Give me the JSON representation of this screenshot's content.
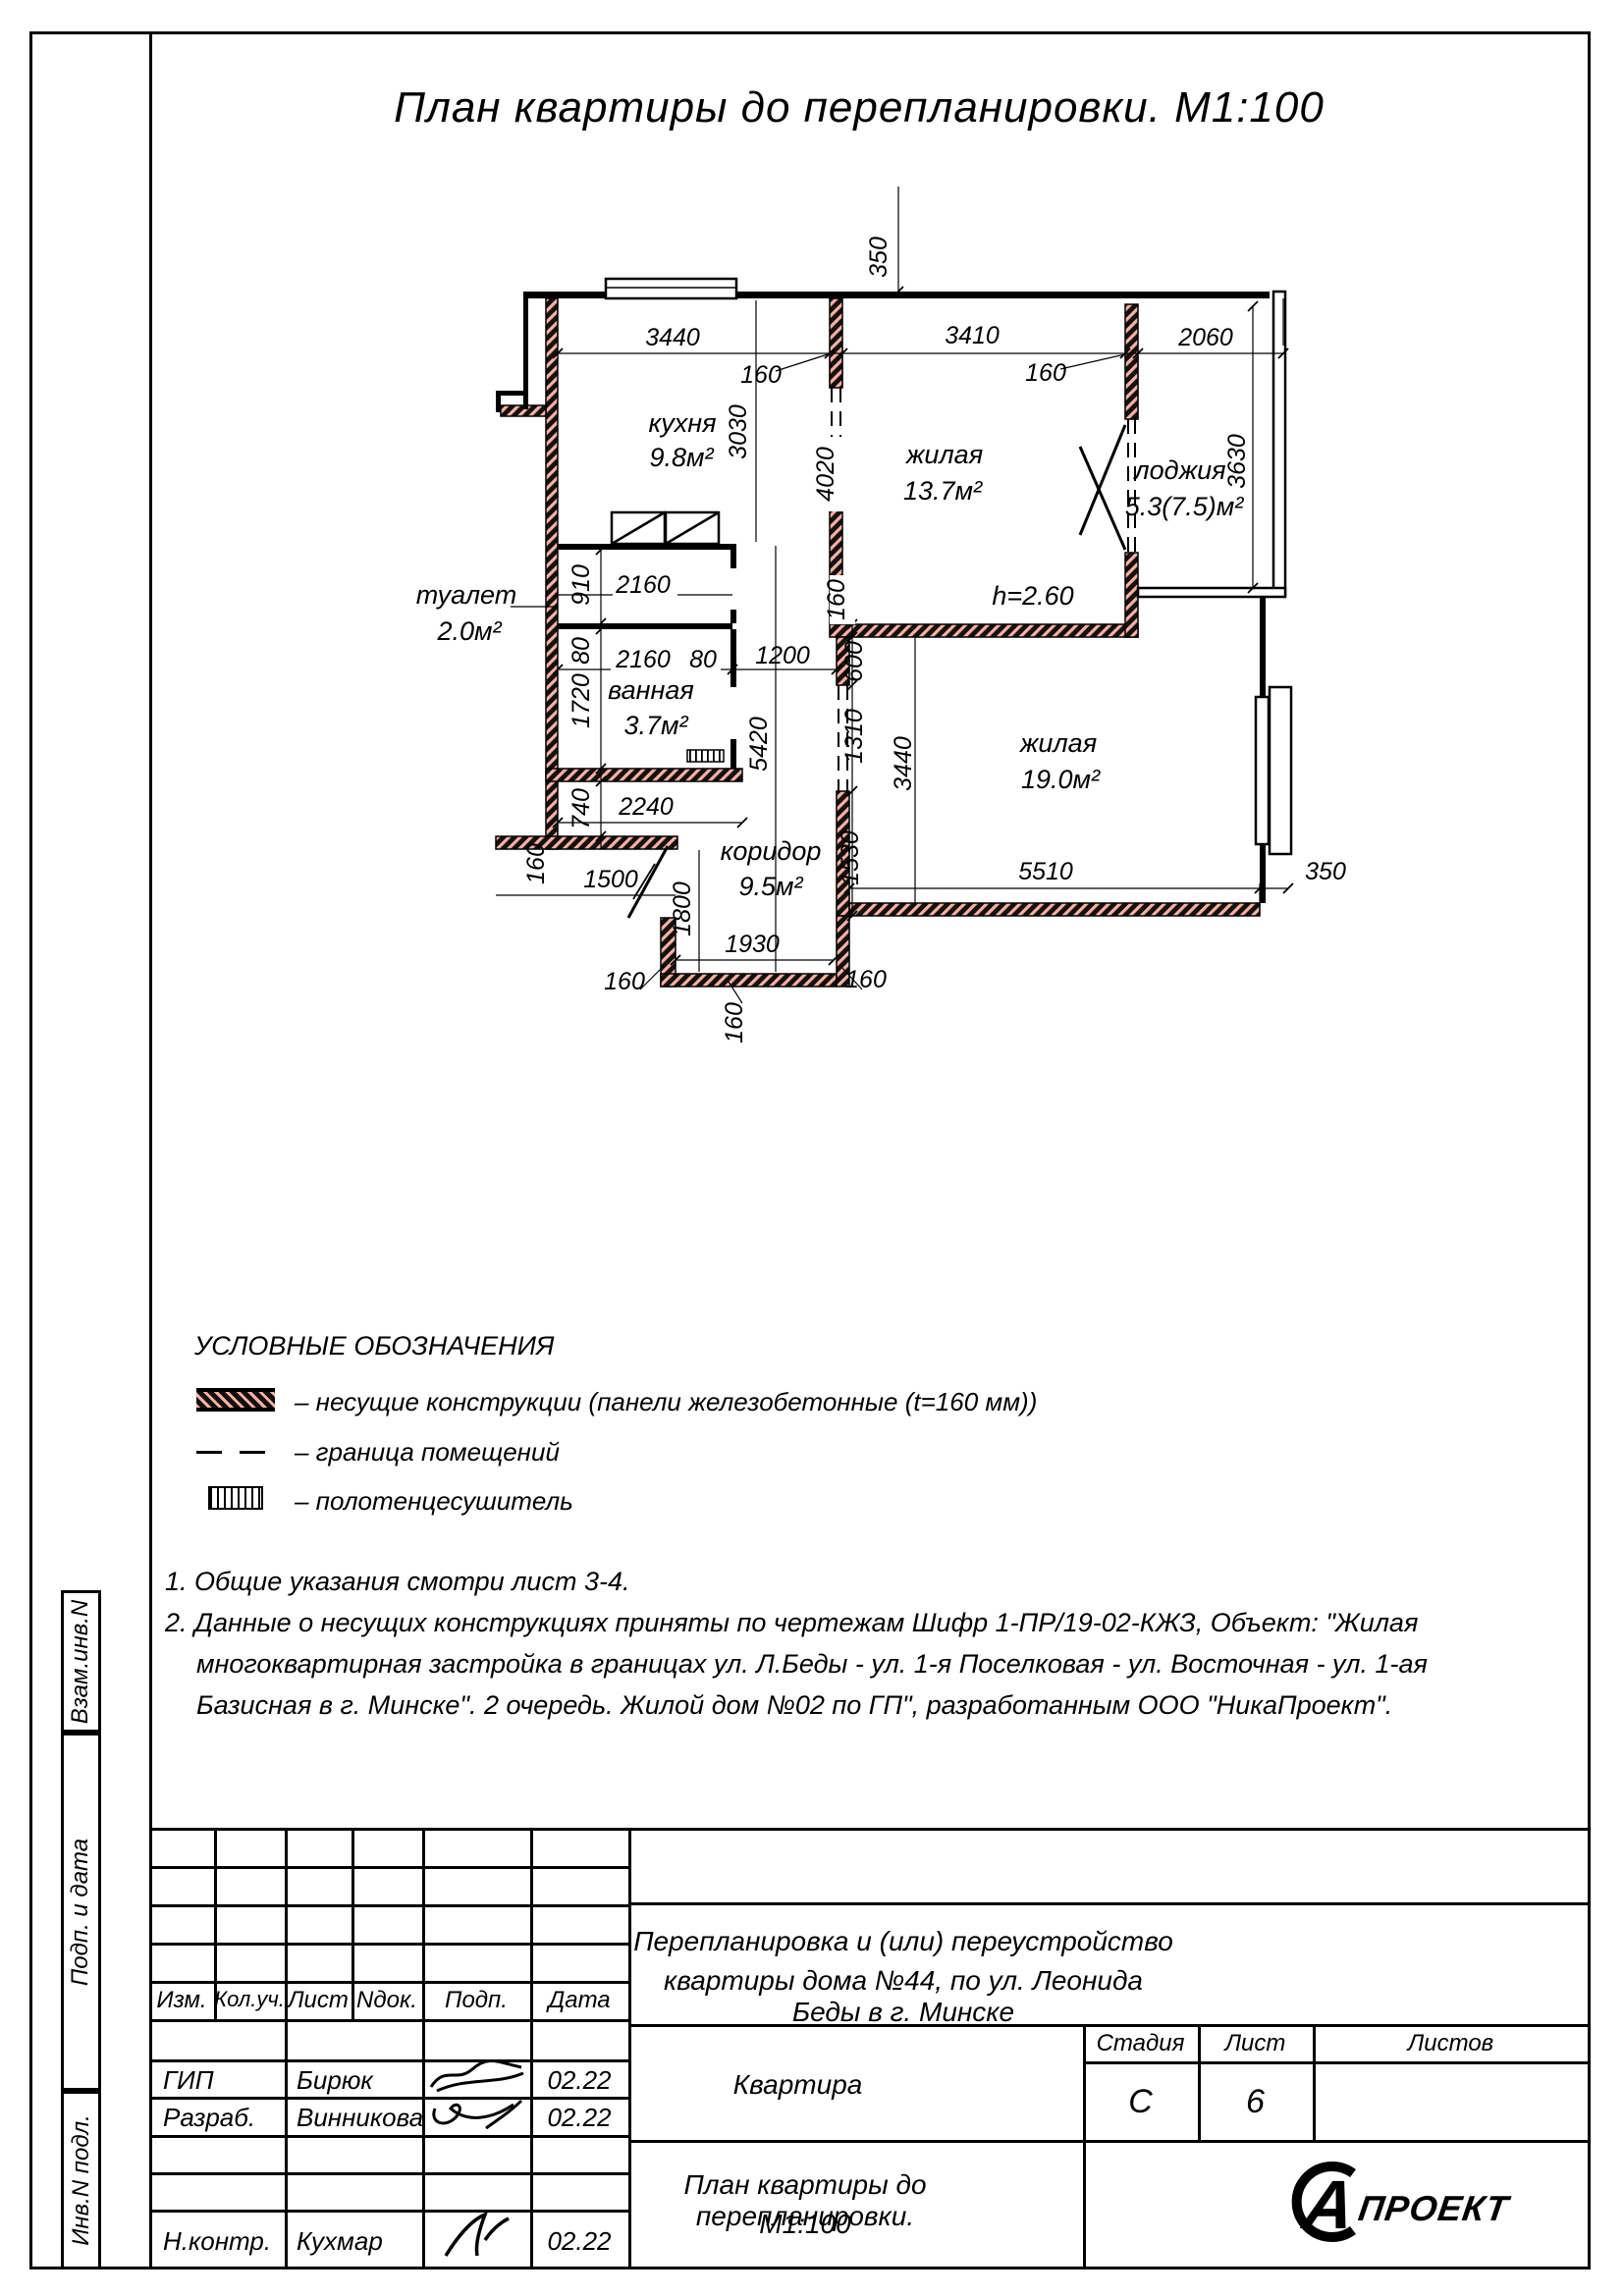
{
  "page_title": "План квартиры до перепланировки. М1:100",
  "plan": {
    "rooms": {
      "kitchen": {
        "name": "кухня",
        "area": "9.8м²"
      },
      "living1": {
        "name": "жилая",
        "area": "13.7м²"
      },
      "loggia": {
        "name": "лоджия",
        "area": "5.3(7.5)м²"
      },
      "toilet": {
        "name": "туалет",
        "area": "2.0м²"
      },
      "bath": {
        "name": "ванная",
        "area": "3.7м²"
      },
      "hall": {
        "name": "коридор",
        "area": "9.5м²"
      },
      "living2": {
        "name": "жилая",
        "area": "19.0м²"
      }
    },
    "height_note": "h=2.60",
    "dims": {
      "d350": "350",
      "d3440": "3440",
      "d160": "160",
      "d3410": "3410",
      "d2060": "2060",
      "d3030": "3030",
      "d4020": "4020",
      "d3630": "3630",
      "d910": "910",
      "d80": "80",
      "d1720": "1720",
      "d740": "740",
      "d2160": "2160",
      "d1200": "1200",
      "d2240": "2240",
      "d5420": "5420",
      "d600": "600",
      "d1310": "1310",
      "d1530": "1530",
      "d5510": "5510",
      "d1930": "1930",
      "d1800": "1800",
      "d1500": "1500"
    },
    "colors": {
      "wall_hatch": "#ffb19c",
      "ink": "#000000"
    }
  },
  "legend": {
    "title": "УСЛОВНЫЕ ОБОЗНАЧЕНИЯ",
    "item1": "– несущие конструкции (панели железобетонные  (t=160 мм))",
    "item2": "– граница помещений",
    "item3": "– полотенцесушитель"
  },
  "notes": {
    "line1": "1. Общие указания смотри лист 3-4.",
    "line2": "2. Данные о несущих конструкциях приняты по чертежам Шифр 1-ПР/19-02-КЖЗ, Объект: \"Жилая",
    "line3": "многоквартирная застройка в границах ул. Л.Беды - ул. 1-я Поселковая - ул. Восточная - ул. 1-ая",
    "line4": "Базисная в г. Минске\". 2 очередь. Жилой дом №02 по ГП\", разработанным ООО \"НикаПроект\"."
  },
  "titleblock": {
    "cols": {
      "c1": "Изм.",
      "c2": "Кол.уч.",
      "c3": "Лист",
      "c4": "Nдок.",
      "c5": "Подп.",
      "c6": "Дата"
    },
    "rows": {
      "r1": {
        "role": "ГИП",
        "name": "Бирюк",
        "date": "02.22"
      },
      "r2": {
        "role": "Разраб.",
        "name": "Винникова",
        "date": "02.22"
      },
      "r3": {
        "role": "Н.контр.",
        "name": "Кухмар",
        "date": "02.22"
      }
    },
    "project_line1": "Перепланировка и (или) переустройство",
    "project_line2": "квартиры дома №44, по ул. Леонида Беды в г. Минске",
    "object": "Квартира",
    "stage_label": "Стадия",
    "sheet_label": "Лист",
    "sheets_label": "Листов",
    "stage": "С",
    "sheet": "6",
    "doc_line1": "План квартиры до перепланировки.",
    "doc_line2": "М1:100",
    "logo_letter": "А",
    "logo_word": "ПРОЕКТ"
  },
  "margin": {
    "box1": "Взам.инв.N",
    "box2": "Подп. и дата",
    "box3": "Инв.N подл."
  }
}
